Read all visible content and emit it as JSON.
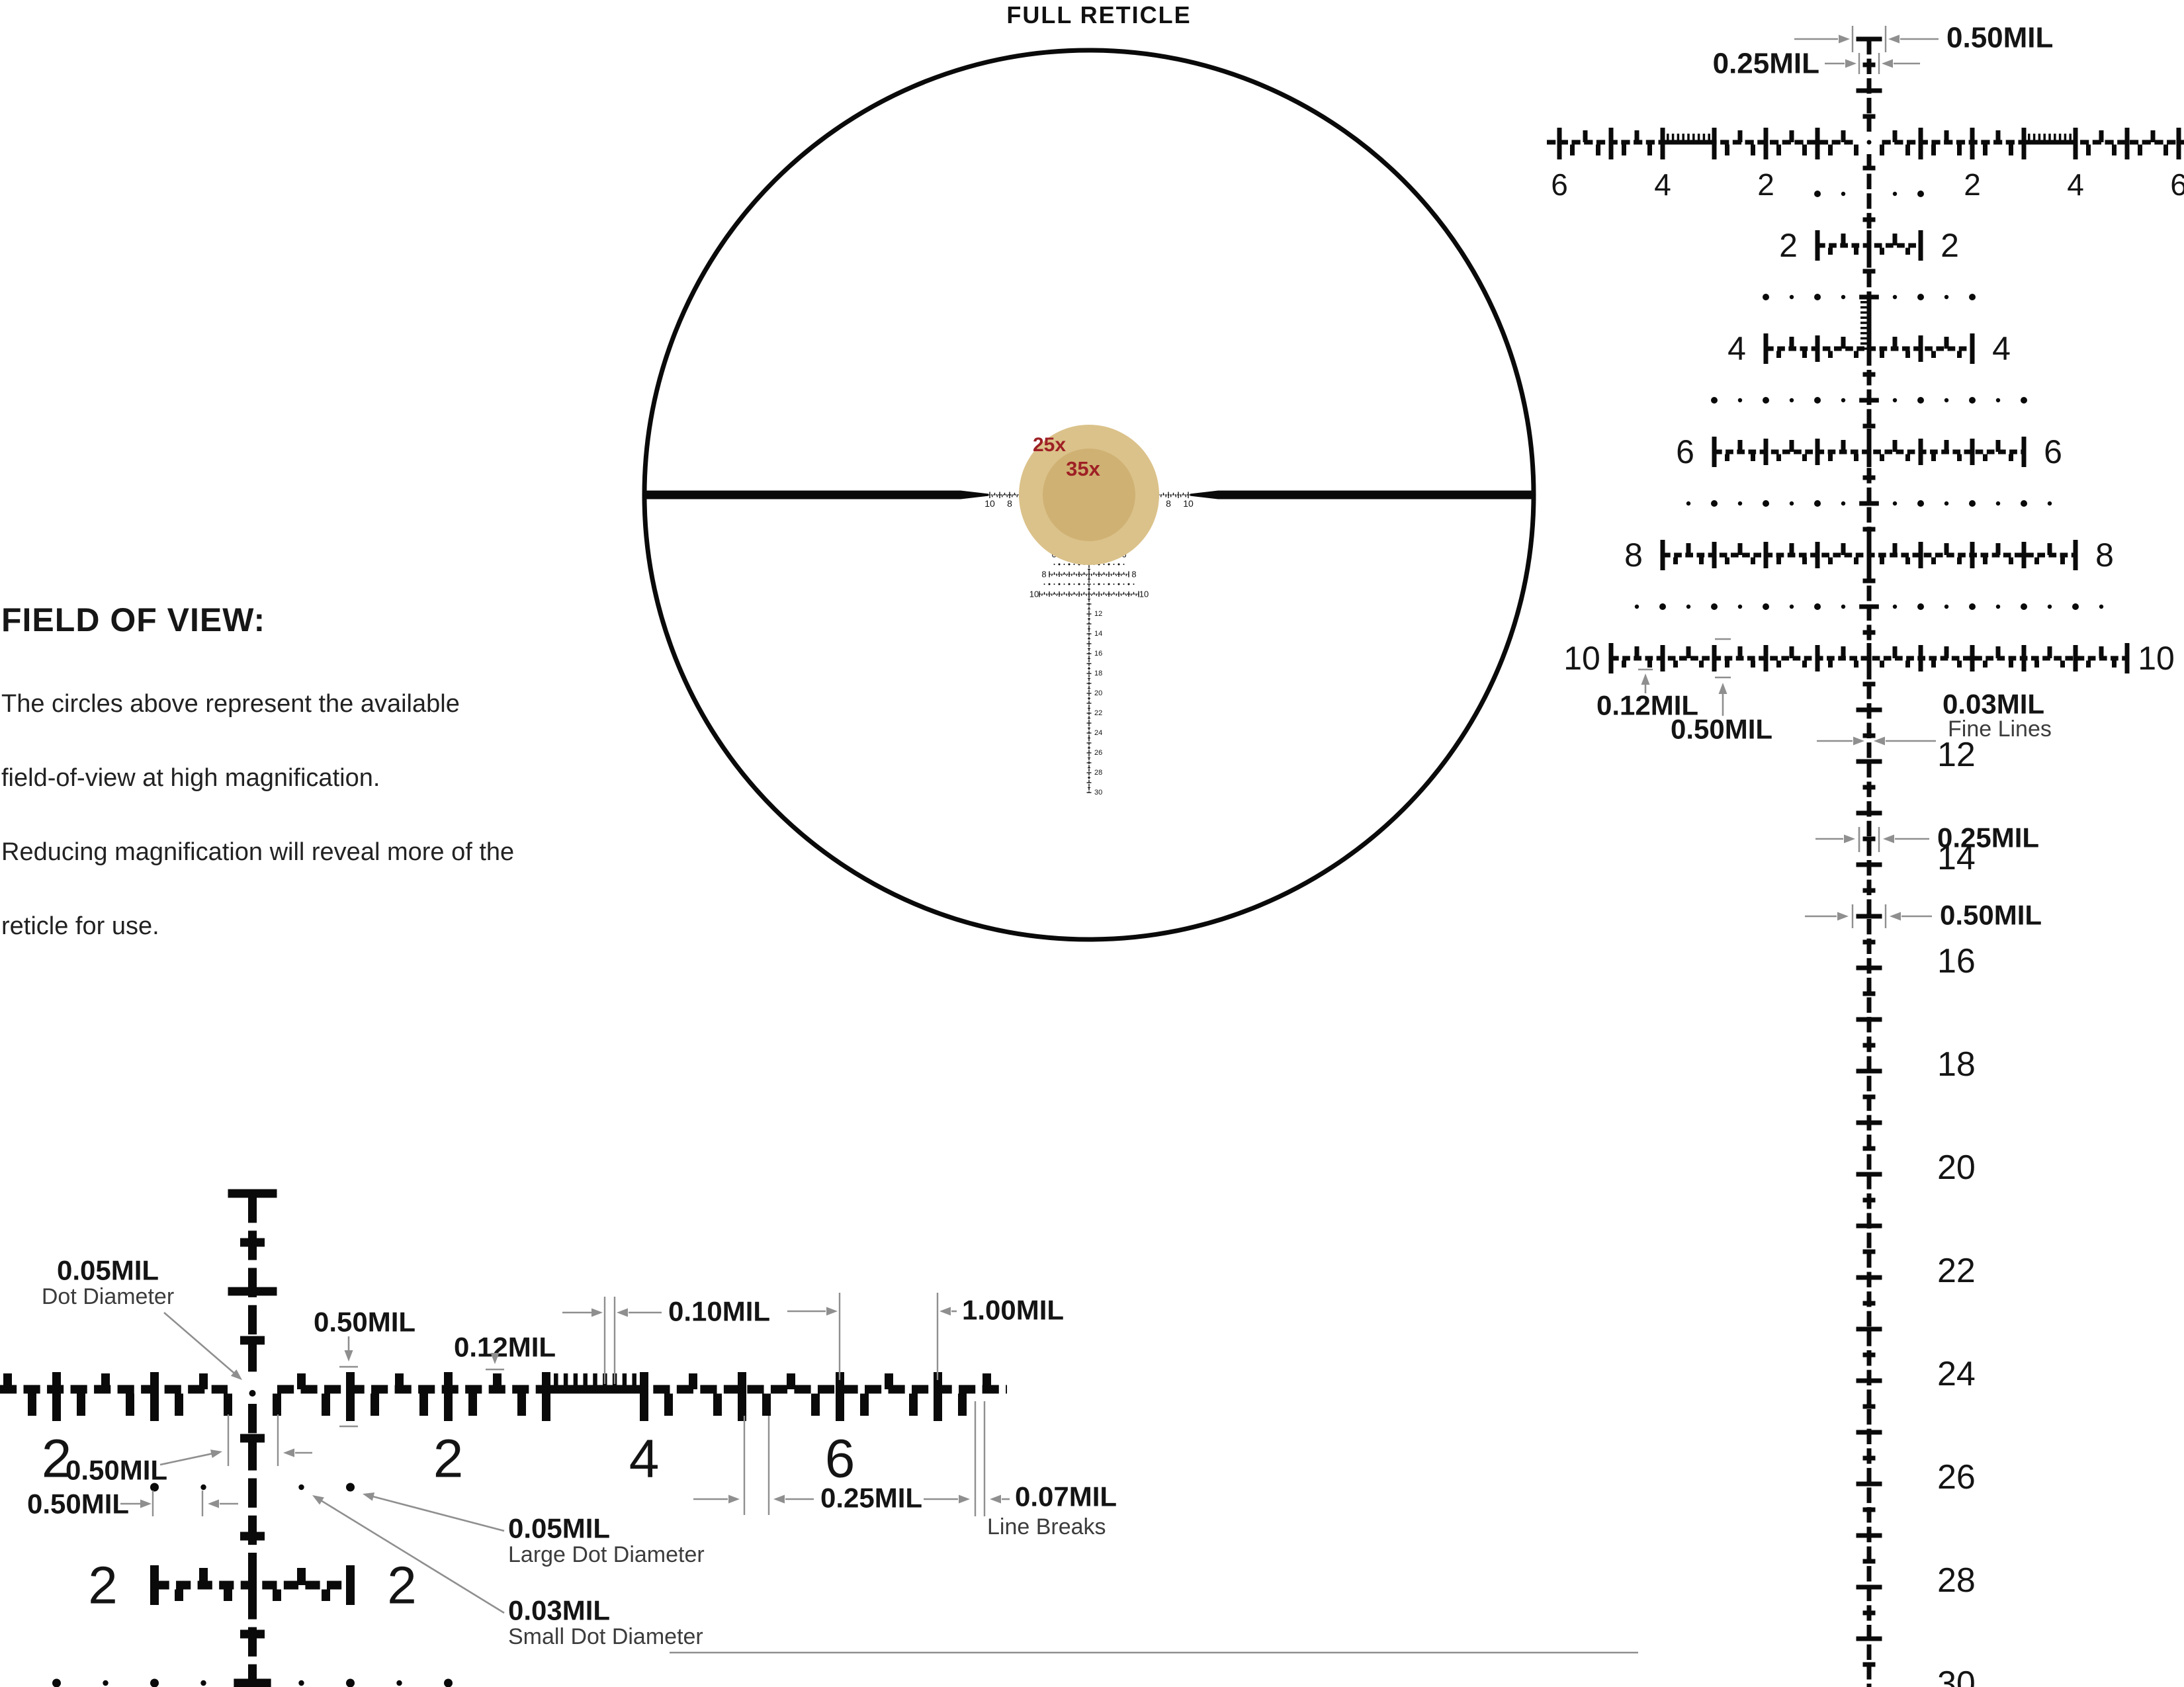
{
  "page": {
    "title": "FULL RETICLE",
    "background": "#ffffff"
  },
  "field_of_view": {
    "heading": "FIELD OF VIEW:",
    "body_lines": [
      "The circles above represent the available",
      "field-of-view at high magnification.",
      "Reducing magnification will reveal more of the",
      "reticle for use."
    ]
  },
  "full_reticle": {
    "magnification_labels": [
      {
        "text": "25x"
      },
      {
        "text": "35x"
      }
    ],
    "axis_numbers": [
      2,
      4,
      6,
      8,
      10
    ],
    "row_numbers": [
      2,
      4,
      6,
      8,
      10
    ],
    "drop_numbers": [
      12,
      14,
      16,
      18,
      20,
      22,
      24,
      26,
      28,
      30
    ]
  },
  "right_diagram": {
    "axis_numbers": [
      2,
      4,
      6
    ],
    "row_numbers": [
      2,
      4,
      6,
      8,
      10
    ],
    "drop_numbers": [
      12,
      14,
      16,
      18,
      20,
      22,
      24,
      26,
      28,
      30
    ],
    "annotations": {
      "top_tick_width": "0.50MIL",
      "top_small_tick_width": "0.25MIL",
      "small_tick_height": "0.12MIL",
      "large_tick_height": "0.50MIL",
      "line_width_value": "0.03MIL",
      "line_width_caption": "Fine Lines",
      "drop_small_tick_width": "0.25MIL",
      "drop_large_tick_width": "0.50MIL"
    }
  },
  "detail_diagram": {
    "axis_numbers_left": [
      2
    ],
    "axis_numbers_right": [
      2,
      4,
      6
    ],
    "row_numbers": [
      2,
      2
    ],
    "annotations": {
      "center_dot_value": "0.05MIL",
      "center_dot_caption": "Dot Diameter",
      "tall_tick_height": "0.50MIL",
      "small_tick_height": "0.12MIL",
      "fine_tick_spacing": "0.10MIL",
      "mil_spacing": "1.00MIL",
      "center_gap": "0.50MIL",
      "dot_spacing": "0.50MIL",
      "quarter_spacing": "0.25MIL",
      "line_breaks_value": "0.07MIL",
      "line_breaks_caption": "Line Breaks",
      "large_dot_value": "0.05MIL",
      "large_dot_caption": "Large Dot Diameter",
      "small_dot_value": "0.03MIL",
      "small_dot_caption": "Small Dot Diameter"
    }
  },
  "colors": {
    "ink": "#0a0a0a",
    "label_text": "#141414",
    "sub_text": "#3c3c3c",
    "annotation_gray": "#8f8f8f",
    "red": "#9e2025",
    "fov_outer": "#dbc28a",
    "fov_inner": "#cfb173"
  }
}
